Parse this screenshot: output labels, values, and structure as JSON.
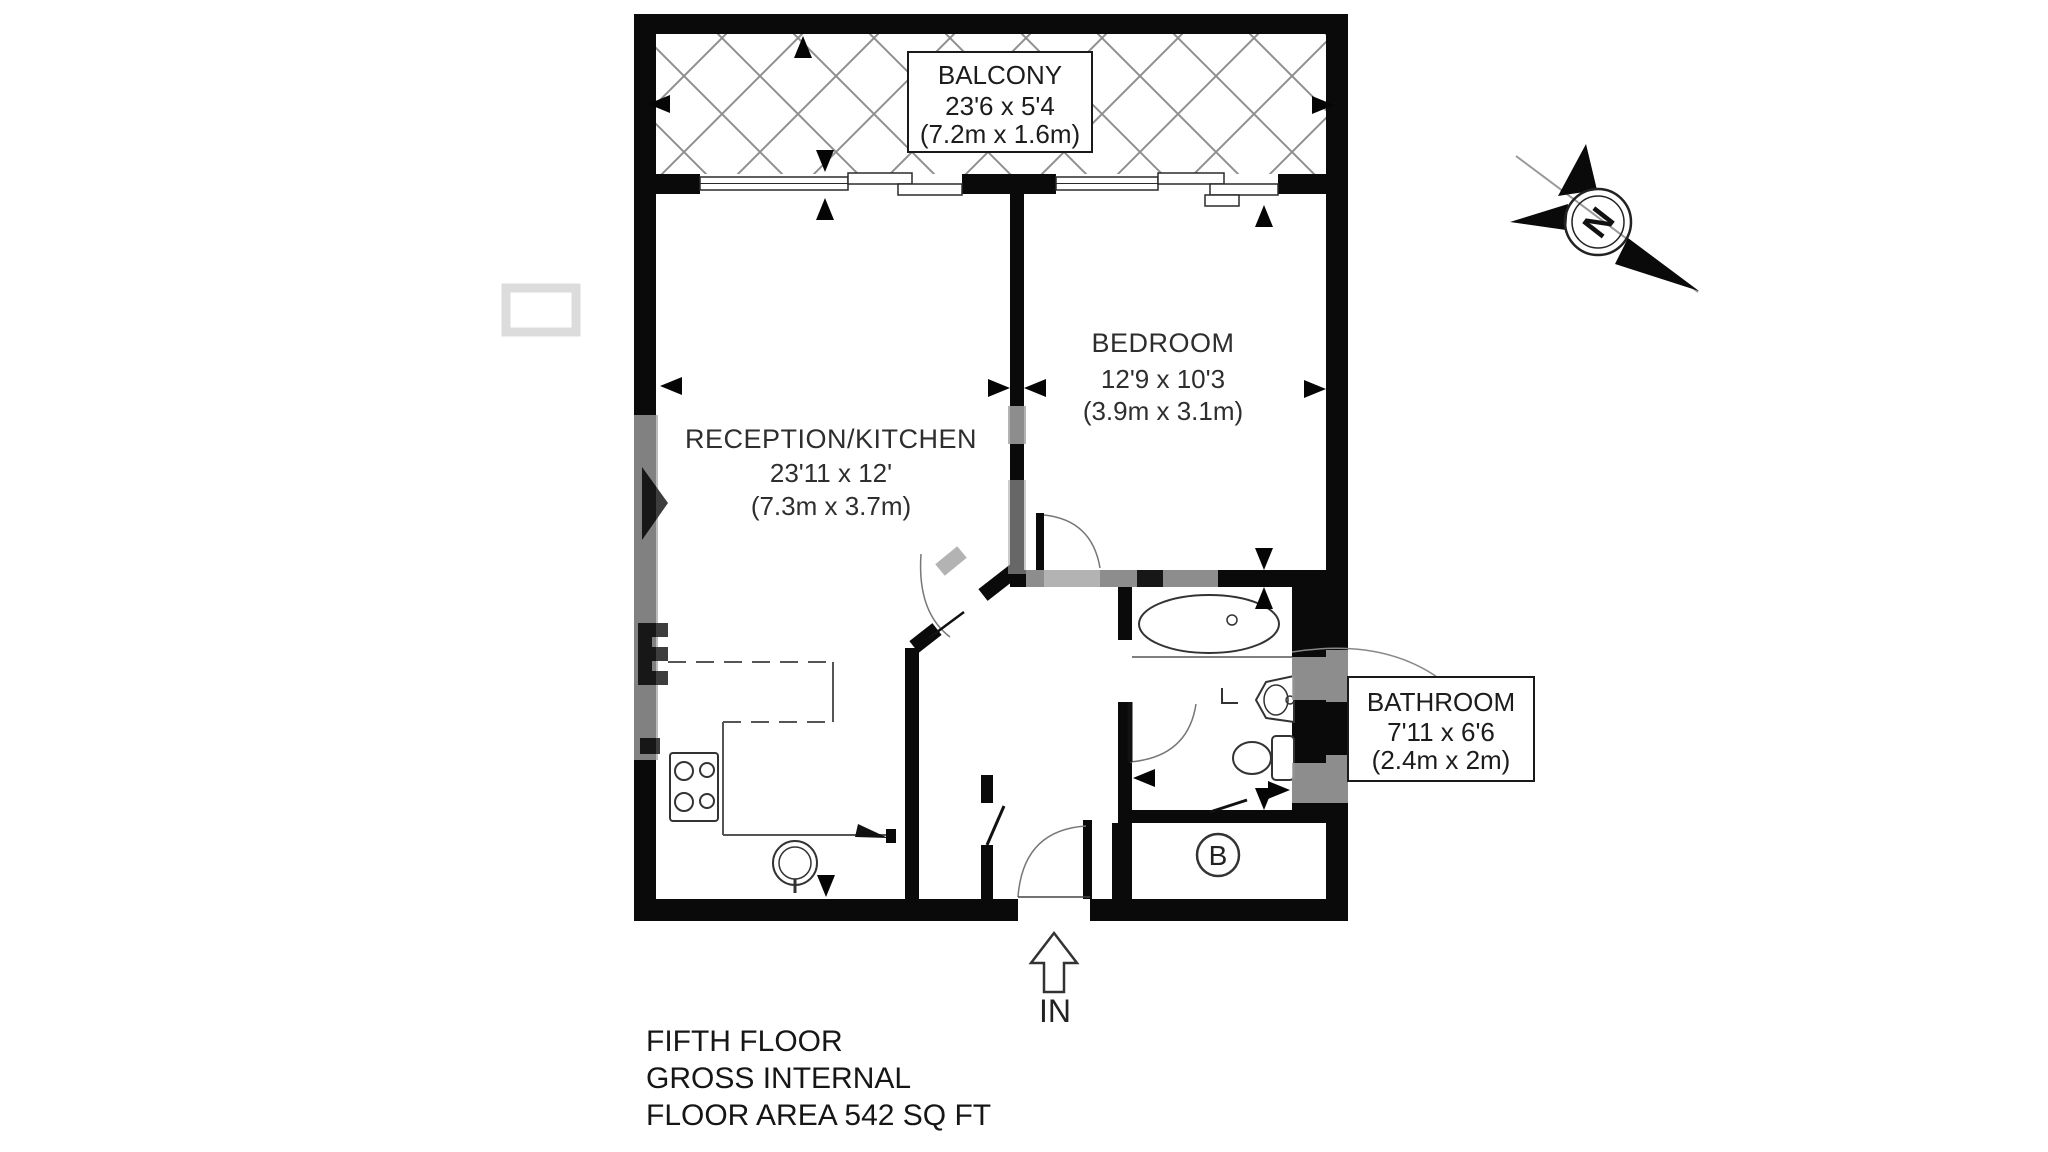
{
  "plan": {
    "footer": [
      "FIFTH FLOOR",
      "GROSS INTERNAL",
      "FLOOR AREA 542 SQ FT"
    ],
    "entrance_label": "IN",
    "boiler_label": "B",
    "compass_label": "N",
    "rooms": {
      "balcony": {
        "name": "BALCONY",
        "size_imperial": "23'6 x 5'4",
        "size_metric": "(7.2m x 1.6m)"
      },
      "reception": {
        "name": "RECEPTION/KITCHEN",
        "size_imperial": "23'11 x 12'",
        "size_metric": "(7.3m x 3.7m)"
      },
      "bedroom": {
        "name": "BEDROOM",
        "size_imperial": "12'9 x 10'3",
        "size_metric": "(3.9m x 3.1m)"
      },
      "bathroom": {
        "name": "BATHROOM",
        "size_imperial": "7'11 x 6'6",
        "size_metric": "(2.4m x 2m)"
      }
    },
    "colors": {
      "wall": "#0a0a0a",
      "hatch": "#8f8f8f",
      "label_text": "#3f3f3f",
      "watermark": "#a6a6a6"
    }
  }
}
